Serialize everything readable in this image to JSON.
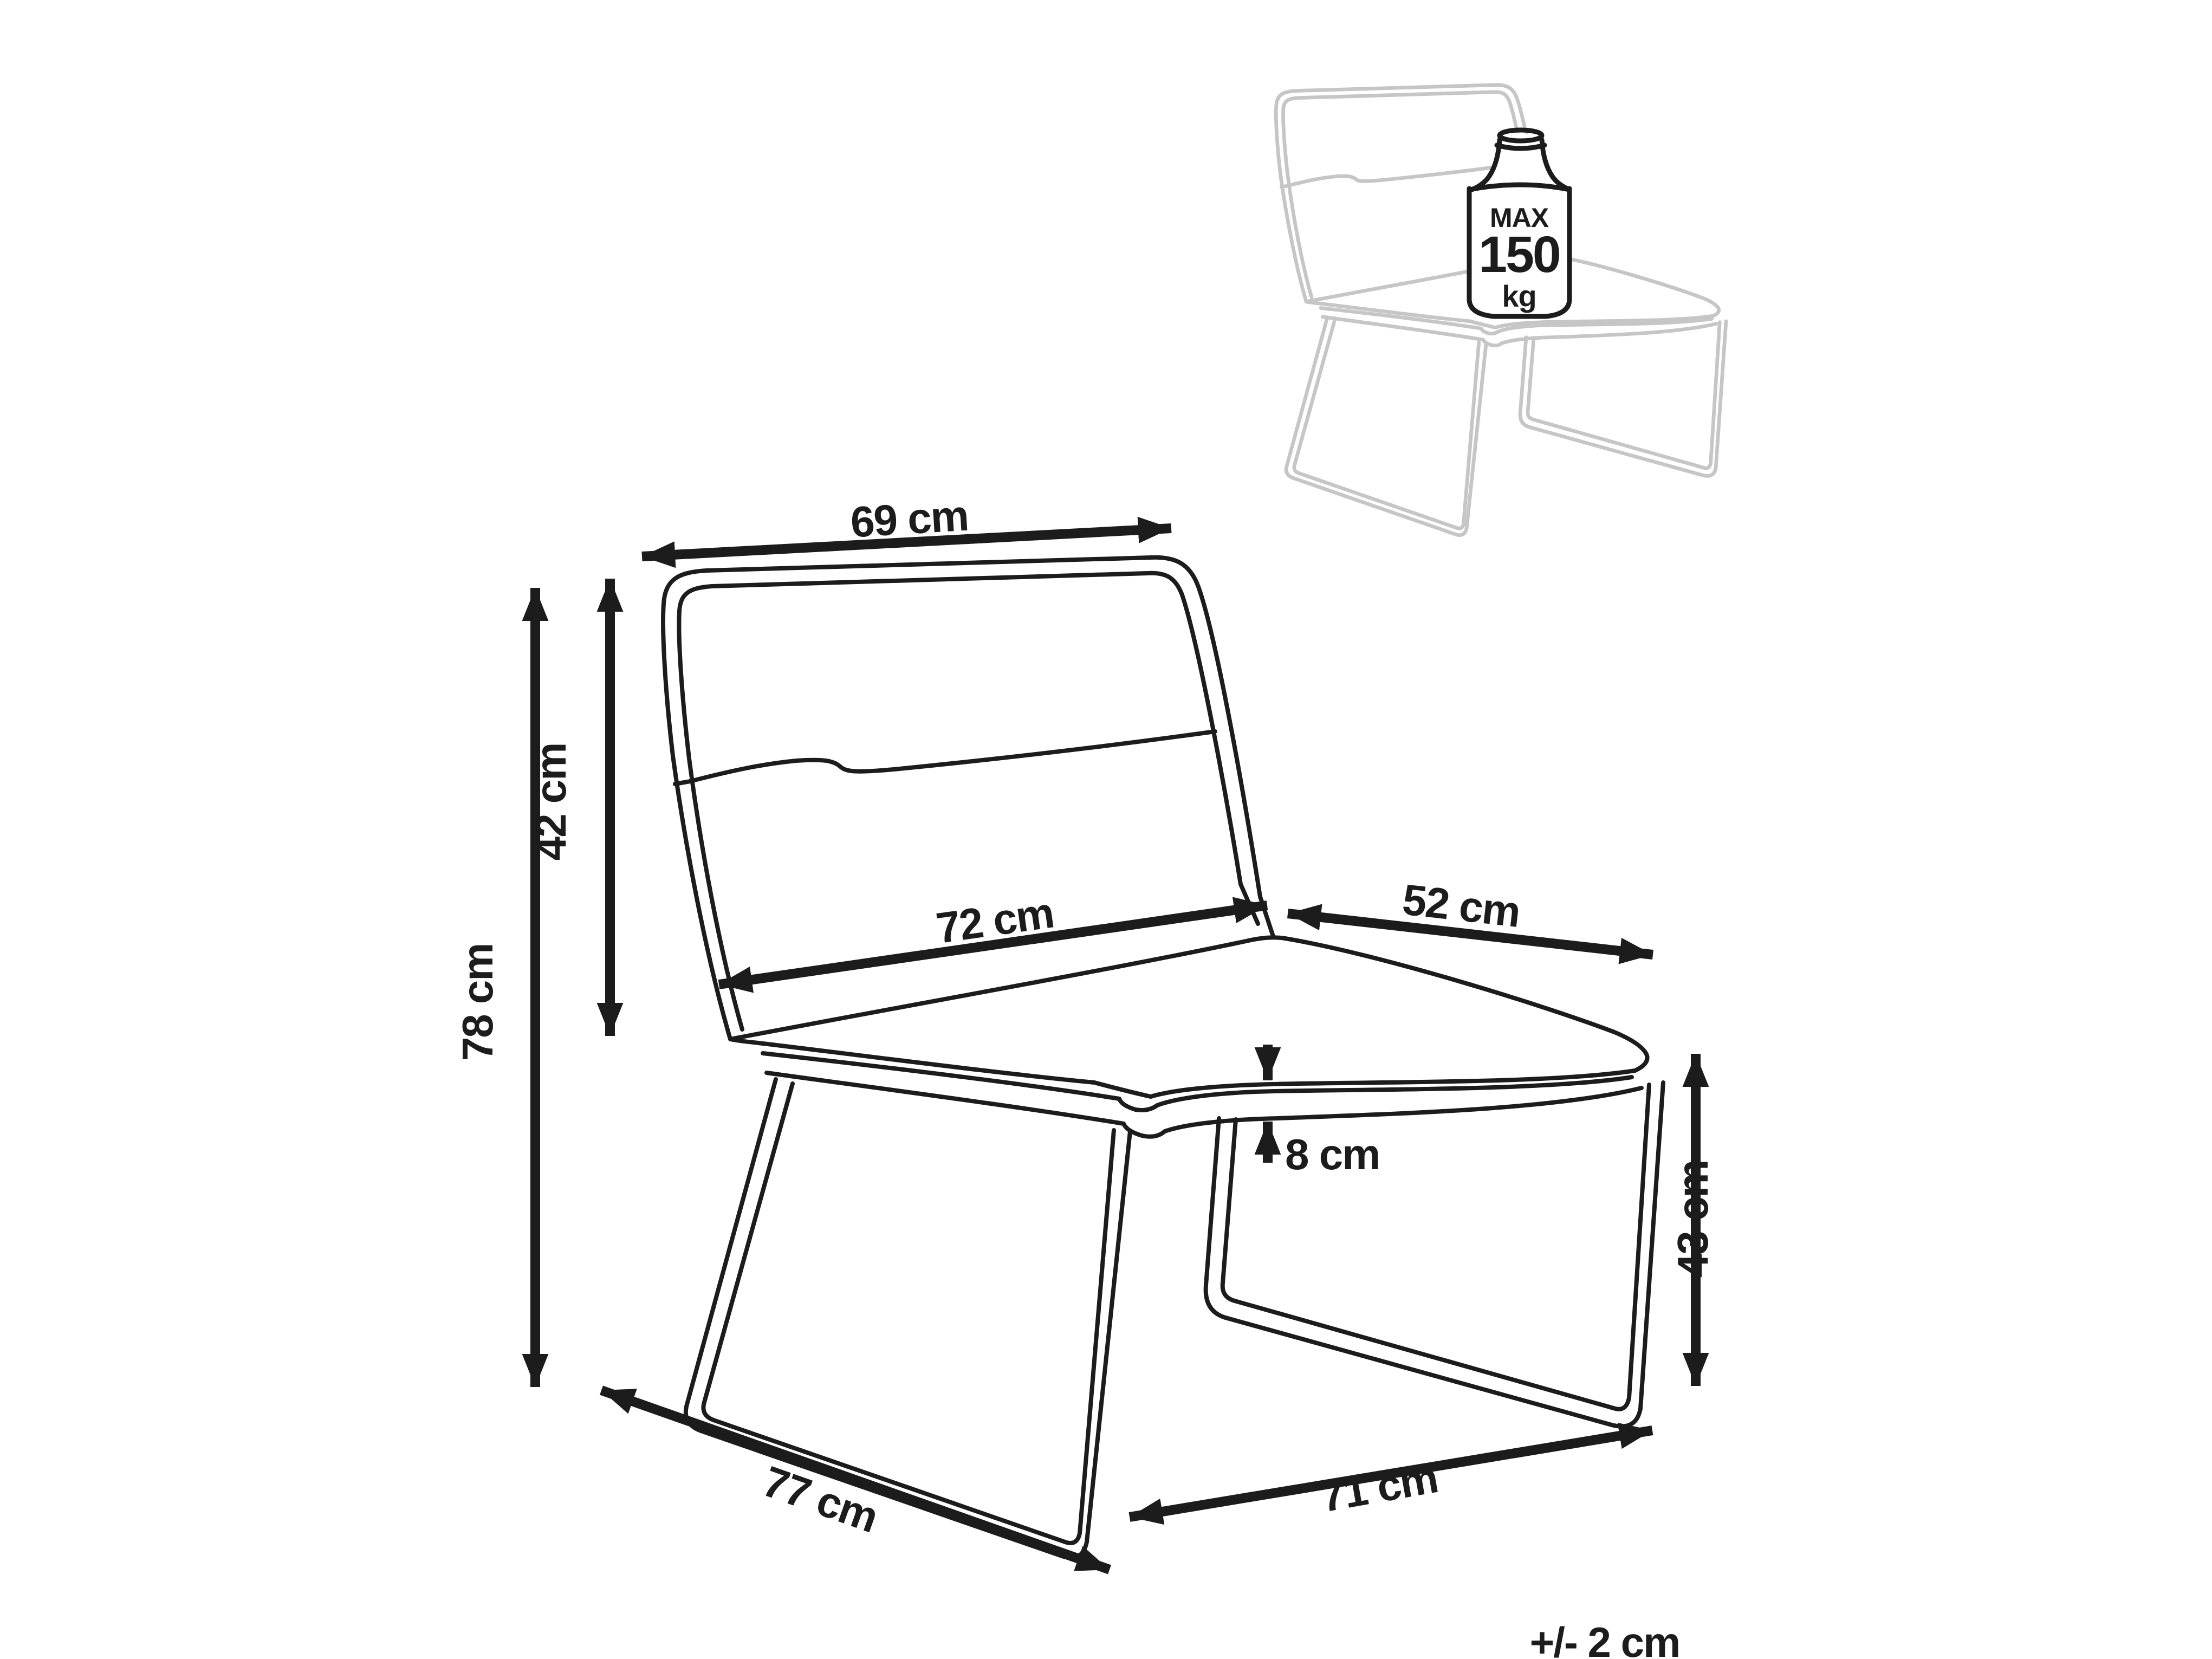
{
  "diagram": {
    "labels": {
      "back_width": "69 cm",
      "backrest_height": "42 cm",
      "overall_height": "78 cm",
      "seat_width": "72 cm",
      "seat_depth": "52 cm",
      "cushion_thickness": "8 cm",
      "clearance_height": "43 cm",
      "base_depth": "77 cm",
      "base_width": "71 cm",
      "tolerance": "+/- 2 cm"
    },
    "max_load_badge": {
      "line1": "MAX",
      "line2": "150",
      "line3": "kg"
    },
    "colors": {
      "line": "#1c1c1c",
      "secondary_chair": "#c6c6c6",
      "background": "#ffffff"
    }
  }
}
